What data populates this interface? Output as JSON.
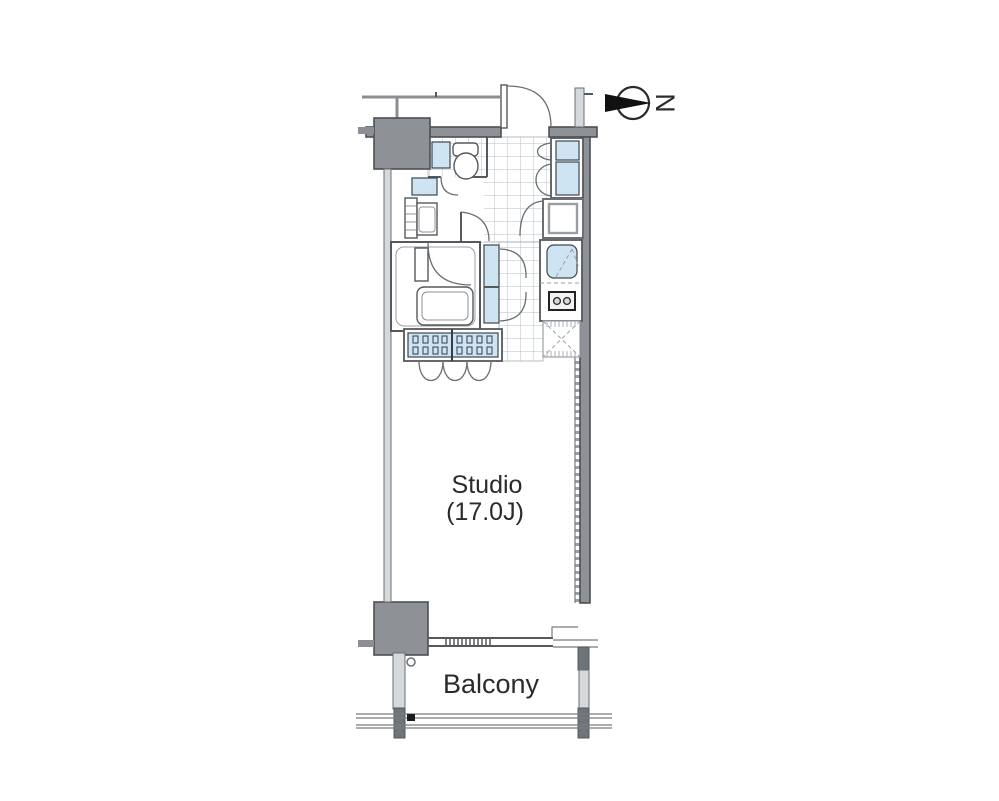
{
  "page": {
    "title": "Apartment floor plan"
  },
  "rooms": {
    "studio": {
      "name": "Studio",
      "area": "(17.0J)"
    },
    "balcony": {
      "name": "Balcony"
    }
  },
  "compass": {
    "letter": "N"
  },
  "symbols": [
    "entrance-door",
    "toilet",
    "washbasin",
    "washing-machine",
    "unit-bath",
    "bathtub",
    "linen-cabinet",
    "wardrobe-hangers",
    "folding-doors",
    "kitchen-sink",
    "gas-stove",
    "refrigerator-space",
    "shoe-closet",
    "storage",
    "sliding-window",
    "balcony-railing",
    "drain-cap",
    "structural-column",
    "north-arrow"
  ],
  "colors": {
    "background": "#ffffff",
    "fixture-blue": "#cfe4f2",
    "wall-gray": "#8e9296",
    "wall-line": "#4c5054",
    "grid-line": "#b6bfc6",
    "text": "#2b2b2b"
  }
}
